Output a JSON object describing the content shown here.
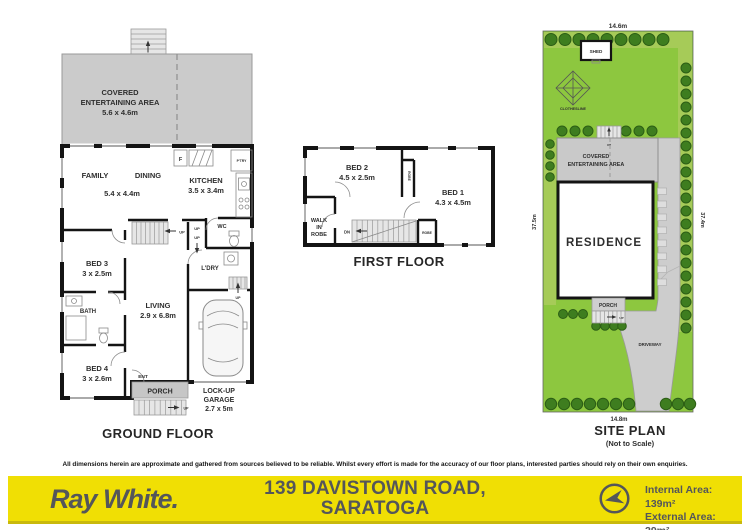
{
  "ground_floor": {
    "caption": "GROUND FLOOR",
    "covered_l1": "COVERED",
    "covered_l2": "ENTERTAINING AREA",
    "covered_size": "5.6 x 4.6m",
    "family": "FAMILY",
    "dining": "DINING",
    "family_dining_size": "5.4 x 4.4m",
    "kitchen": "KITCHEN",
    "kitchen_size": "3.5 x 3.4m",
    "fridge": "F",
    "pantry": "P'TRY",
    "wc": "WC",
    "laundry": "L'DRY",
    "bed3": "BED 3",
    "bed3_size": "3 x 2.5m",
    "bath": "BATH",
    "bed4": "BED 4",
    "bed4_size": "3 x 2.6m",
    "living": "LIVING",
    "living_size": "2.9 x 6.8m",
    "ent": "ENT",
    "porch": "PORCH",
    "garage_l1": "LOCK-UP",
    "garage_l2": "GARAGE",
    "garage_size": "2.7 x 5m"
  },
  "first_floor": {
    "caption": "FIRST FLOOR",
    "bed2": "BED 2",
    "bed2_size": "4.5 x 2.5m",
    "bed1": "BED 1",
    "bed1_size": "4.3 x 4.5m",
    "wir_l1": "WALK",
    "wir_l2": "IN",
    "wir_l3": "ROBE",
    "robe": "ROBE",
    "dn": "DN"
  },
  "site_plan": {
    "caption": "SITE PLAN",
    "not_to_scale": "(Not to Scale)",
    "dim_top": "14.6m",
    "dim_bottom": "14.8m",
    "dim_left": "37.5m",
    "dim_right": "37.4m",
    "shed": "SHED",
    "clothesline": "CLOTHESLINE",
    "covered_l1": "COVERED",
    "covered_l2": "ENTERTAINING AREA",
    "residence": "RESIDENCE",
    "porch": "PORCH",
    "driveway": "DRIVEWAY"
  },
  "common": {
    "up": "UP"
  },
  "footer": {
    "disclaimer": "All dimensions herein are approximate and gathered from sources believed to be reliable. Whilst every effort is made for the accuracy of our floor plans, interested parties should rely on their own enquiries.",
    "brand": "Ray White.",
    "address_l1": "139 DAVISTOWN ROAD,",
    "address_l2": "SARATOGA",
    "internal_area": "Internal Area: 139m²",
    "external_area": "External Area: 29m²"
  },
  "colors": {
    "band_yellow": "#F0DF04",
    "footer_text": "#54565A",
    "lawn_green": "#8DC73F",
    "tree_green": "#3E7D1F",
    "plan_gray": "#C9C9C9"
  }
}
